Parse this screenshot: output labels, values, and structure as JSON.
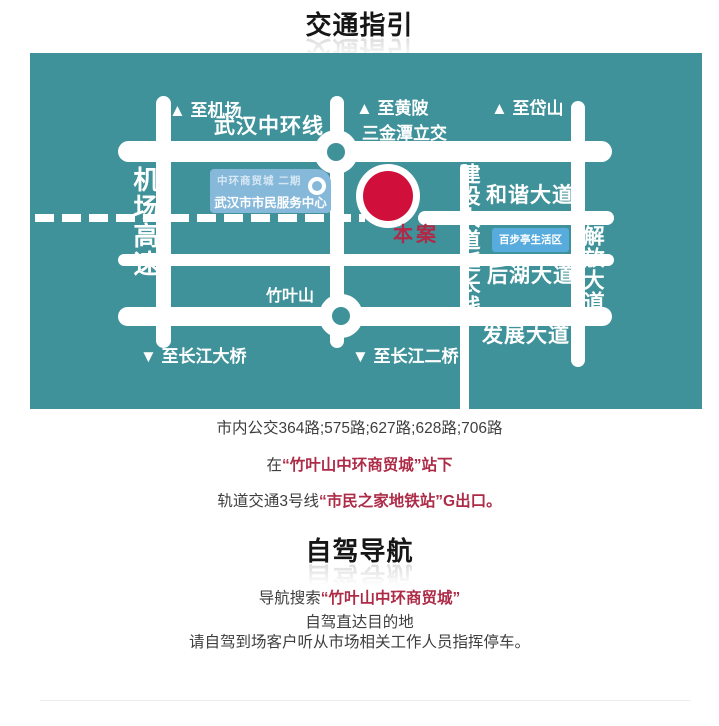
{
  "sections": {
    "transit_title": "交通指引",
    "driving_title": "自驾导航"
  },
  "map": {
    "labels": {
      "to_airport": "▲ 至机场",
      "wuhan_ring_road": "武汉中环线",
      "to_huangpi": "▲ 至黄陂",
      "sanjintan_interchange": "三金潭立交",
      "to_daishan": "▲ 至岱山",
      "airport_expressway": "机场高速",
      "hexie_avenue": "和谐大道",
      "jiefang_avenue": "解放大道",
      "jiefang_arrow": "▶",
      "jianshe_extension": "建设大道延长线",
      "houhu_avenue": "后湖大道",
      "fazhan_avenue": "发展大道",
      "zhuyeshan": "竹叶山",
      "to_yangtze_bridge": "▼ 至长江大桥",
      "to_second_yangtze_bridge": "▼ 至长江二桥",
      "site_marker": "本案",
      "service_center_line1": "中环商贸城 二期",
      "service_center_line2": "武汉市市民服务中心",
      "baibuting_area": "百步亭生活区"
    },
    "colors": {
      "map_background": "#3f919a",
      "road": "#ffffff",
      "site_marker_red": "#d0103a",
      "site_label_red": "#b22846",
      "service_box_blue": "#86b8da",
      "baibuting_box_blue": "#58acdd"
    }
  },
  "transit": {
    "bus_lines": "市内公交364路;575路;627路;628路;706路",
    "stop_prefix": "在",
    "stop_highlight": "“竹叶山中环商贸城”站下",
    "metro_prefix": "轨道交通3号线",
    "metro_highlight": "“市民之家地铁站”G出口。"
  },
  "driving": {
    "nav_prefix": "导航搜索",
    "nav_highlight": "“竹叶山中环商贸城”",
    "line2": "自驾直达目的地",
    "line3": "请自驾到场客户听从市场相关工作人员指挥停车。"
  },
  "text_colors": {
    "body_text": "#3e3e3e",
    "highlight_red": "#ad2b47",
    "title_black": "#161616"
  }
}
